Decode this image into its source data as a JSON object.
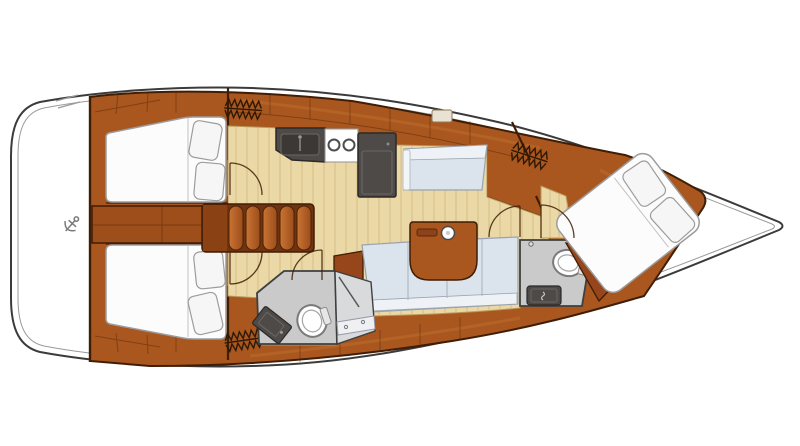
{
  "canvas": {
    "width": 800,
    "height": 446
  },
  "diagram": {
    "type": "sailboat-interior-floor-plan",
    "view": "top-down-deck-plan",
    "orientation": {
      "stern": "left",
      "bow": "right"
    },
    "rooms": [
      {
        "id": "aft-cabin-port",
        "features": [
          "double-berth",
          "two-pillows",
          "hanging-locker",
          "door-swing"
        ]
      },
      {
        "id": "aft-cabin-starboard",
        "features": [
          "double-berth",
          "two-pillows",
          "hanging-locker",
          "door-swing"
        ]
      },
      {
        "id": "companionway",
        "features": [
          "steps"
        ]
      },
      {
        "id": "galley",
        "features": [
          "sink",
          "two-burner-stove",
          "refrigerator"
        ]
      },
      {
        "id": "saloon",
        "features": [
          "l-shaped-settee",
          "table",
          "cup-holder",
          "nav-bench"
        ]
      },
      {
        "id": "head-aft",
        "features": [
          "toilet",
          "sink",
          "shower",
          "door-swing"
        ]
      },
      {
        "id": "head-forward",
        "features": [
          "toilet",
          "sink",
          "door-swing"
        ]
      },
      {
        "id": "forward-cabin",
        "features": [
          "island-double-berth",
          "two-pillows",
          "hanging-locker",
          "door-swing"
        ]
      }
    ],
    "icons": [
      "anchor-icon",
      "hanger-icon",
      "toilet-icon",
      "sink-icon",
      "burner-icon",
      "cup-holder-icon",
      "door-swing-arc"
    ]
  },
  "colors": {
    "white": "#ffffff",
    "hull_outline": "#3b3b3b",
    "hull_inner": "#9a9a9a",
    "wood_main": "#a9571f",
    "wood_light": "#c1732f",
    "wood_dark": "#96461a",
    "wood_deep": "#6f3310",
    "trim": "#401d05",
    "floor": "#ead9a6",
    "floor_line": "#d0b57f",
    "floor_edge": "#b89858",
    "settee": "#dbe3ec",
    "settee_light": "#eef2f6",
    "settee_outline": "#9aa3ad",
    "bed": "#fcfcfc",
    "bed_outline": "#9c9c9c",
    "pillow": "#f6f6f6",
    "head_floor": "#cacaca",
    "head_floor_light": "#d8dadb",
    "head_outline": "#3f3f3f",
    "unit": "#4e4a47",
    "unit_dark": "#3b3835",
    "unit_inner": "#6b6764",
    "unit_edge": "#2b2927",
    "icon": "#2e1804",
    "metal": "#7a7a7a"
  }
}
